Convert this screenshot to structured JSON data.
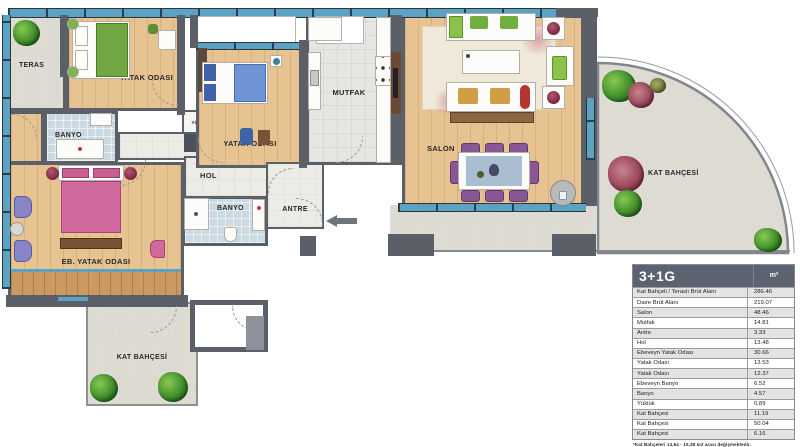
{
  "plan": {
    "rooms": {
      "teras": {
        "label": "TERAS"
      },
      "yatak_odasi_1": {
        "label": "YATAK ODASI"
      },
      "yatak_odasi_2": {
        "label": "YATAK ODASI"
      },
      "eb_yatak_odasi": {
        "label": "EB. YATAK ODASI"
      },
      "ebeveyn_banyo": {
        "label": "BANYO"
      },
      "banyo": {
        "label": "BANYO"
      },
      "yukluk": {
        "label": "YÜKLÜK"
      },
      "hol": {
        "label": "HOL"
      },
      "antre": {
        "label": "ANTRE"
      },
      "mutfak": {
        "label": "MUTFAK"
      },
      "salon": {
        "label": "SALON"
      },
      "kat_bahcesi_sol": {
        "label": "KAT BAHÇESİ"
      },
      "kat_bahcesi_sag": {
        "label": "KAT BAHÇESİ"
      }
    },
    "colors": {
      "wall": "#5a5f68",
      "window": "#5ba3c4",
      "wood_floor": "#e6c391",
      "concrete_floor": "#dedbd3",
      "bath_floor": "#cbd9e3",
      "table_header": "#5b6370"
    }
  },
  "table": {
    "title": "3+1G",
    "unit": "m²",
    "rows": [
      {
        "label": "Kat Bahçeli / Teraslı Brüt Alanı",
        "value": "286.46"
      },
      {
        "label": "Daire Brüt Alanı",
        "value": "219.07"
      },
      {
        "label": "Salon",
        "value": "48.46"
      },
      {
        "label": "Mutfak",
        "value": "14.81"
      },
      {
        "label": "Antre",
        "value": "3.33"
      },
      {
        "label": "Hol",
        "value": "13.48"
      },
      {
        "label": "Ebeveyn Yatak Odası",
        "value": "30.66"
      },
      {
        "label": "Yatak Odası",
        "value": "13.53"
      },
      {
        "label": "Yatak Odası",
        "value": "12.37"
      },
      {
        "label": "Ebeveyn Banyo",
        "value": "6.52"
      },
      {
        "label": "Banyo",
        "value": "4.57"
      },
      {
        "label": "Yüklük",
        "value": "0.89"
      },
      {
        "label": "Kat Bahçesi",
        "value": "11.19"
      },
      {
        "label": "Kat Bahçesi",
        "value": "50.04"
      },
      {
        "label": "Kat Bahçesi",
        "value": "6.16"
      }
    ],
    "footnote": "*Kat Bahçeleri 14,64 - 16,38 m2 arası değişmektedir."
  }
}
